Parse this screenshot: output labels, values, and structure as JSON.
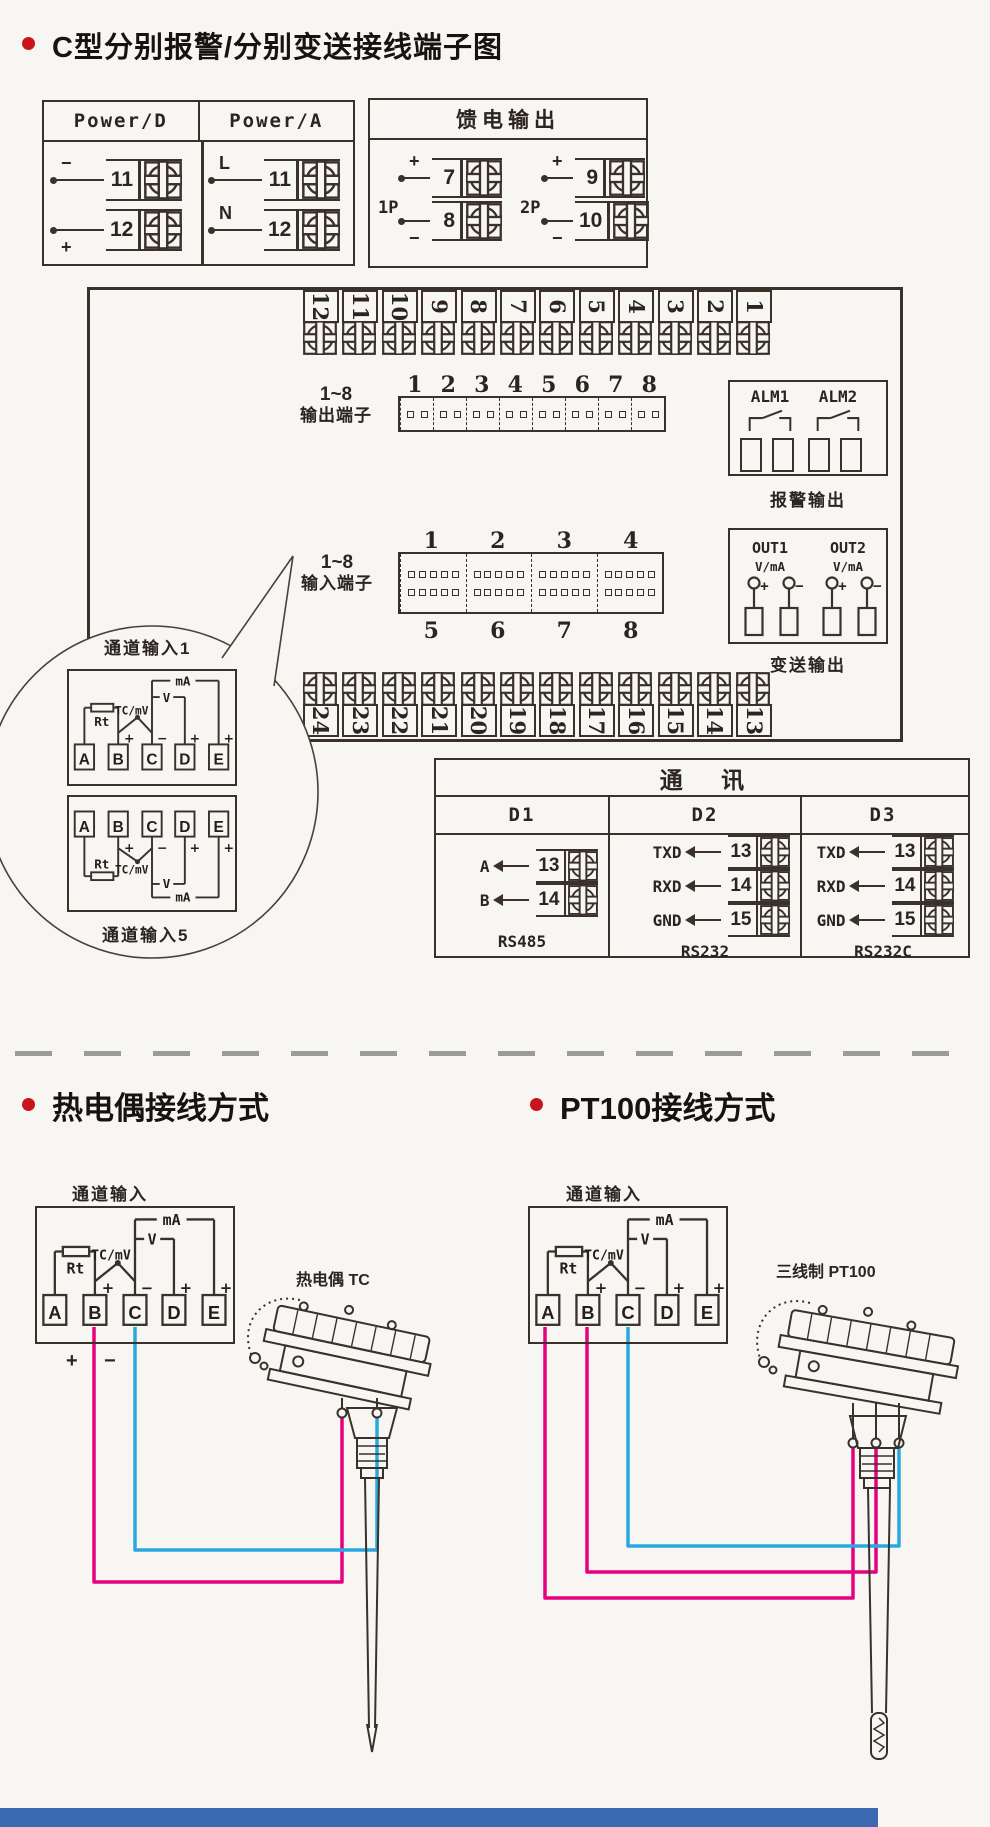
{
  "colors": {
    "ink": "#3a312b",
    "background": "#f7f6f3",
    "accent_red": "#c9141c",
    "wire_pink": "#e5007d",
    "wire_cyan": "#29a8e0",
    "footer_blue": "#3b6ab2"
  },
  "section1": {
    "title": "C型分别报警/分别变送接线端子图",
    "power": {
      "columns": [
        {
          "header": "Power/D",
          "rows": [
            {
              "sign": "−",
              "num": "11"
            },
            {
              "sign": "+",
              "num": "12"
            }
          ]
        },
        {
          "header": "Power/A",
          "rows": [
            {
              "sign": "L",
              "num": "11"
            },
            {
              "sign": "N",
              "num": "12"
            }
          ]
        }
      ]
    },
    "feed": {
      "title": "馈电输出",
      "groups": [
        {
          "label": "1P",
          "rows": [
            {
              "sign": "+",
              "num": "7"
            },
            {
              "sign": "−",
              "num": "8"
            }
          ]
        },
        {
          "label": "2P",
          "rows": [
            {
              "sign": "+",
              "num": "9"
            },
            {
              "sign": "−",
              "num": "10"
            }
          ]
        }
      ]
    },
    "board": {
      "top_terminals": [
        "12",
        "11",
        "10",
        "9",
        "8",
        "7",
        "6",
        "5",
        "4",
        "3",
        "2",
        "1"
      ],
      "bottom_terminals": [
        "24",
        "23",
        "22",
        "21",
        "20",
        "19",
        "18",
        "17",
        "16",
        "15",
        "14",
        "13"
      ],
      "output": {
        "range": "1~8",
        "label": "输出端子",
        "numbers": [
          "1",
          "2",
          "3",
          "4",
          "5",
          "6",
          "7",
          "8"
        ]
      },
      "input": {
        "range": "1~8",
        "label": "输入端子",
        "numbers_top": [
          "1",
          "2",
          "3",
          "4"
        ],
        "numbers_bottom": [
          "5",
          "6",
          "7",
          "8"
        ]
      },
      "alarm": {
        "ch1": "ALM1",
        "ch2": "ALM2",
        "caption": "报警输出"
      },
      "transmit": {
        "ch1": "OUT1",
        "ch2": "OUT2",
        "unit": "V/mA",
        "plus": "+",
        "minus": "−",
        "caption": "变送输出"
      }
    },
    "callout": {
      "label_top": "通道输入1",
      "label_bottom": "通道输入5"
    },
    "comm": {
      "title": "通 讯",
      "columns": [
        {
          "header": "D1",
          "rows": [
            {
              "signal": "A",
              "terminal": "13"
            },
            {
              "signal": "B",
              "terminal": "14"
            }
          ],
          "caption": "RS485"
        },
        {
          "header": "D2",
          "rows": [
            {
              "signal": "TXD",
              "terminal": "13"
            },
            {
              "signal": "RXD",
              "terminal": "14"
            },
            {
              "signal": "GND",
              "terminal": "15"
            }
          ],
          "caption": "RS232"
        },
        {
          "header": "D3",
          "rows": [
            {
              "signal": "TXD",
              "terminal": "13"
            },
            {
              "signal": "RXD",
              "terminal": "14"
            },
            {
              "signal": "GND",
              "terminal": "15"
            }
          ],
          "caption": "RS232C"
        }
      ]
    }
  },
  "channel_circuit": {
    "terminals": [
      "A",
      "B",
      "C",
      "D",
      "E"
    ],
    "rt": "Rt",
    "tc": "TC/mV",
    "v": "V",
    "ma": "mA",
    "sign_b": "+",
    "sign_c": "−",
    "sign_d": "+",
    "sign_e": "+"
  },
  "section2": {
    "tc": {
      "title": "热电偶接线方式",
      "channel": "通道输入",
      "probe": "热电偶 TC",
      "plus": "+",
      "minus": "−"
    },
    "pt": {
      "title": "PT100接线方式",
      "channel": "通道输入",
      "probe": "三线制 PT100"
    }
  }
}
